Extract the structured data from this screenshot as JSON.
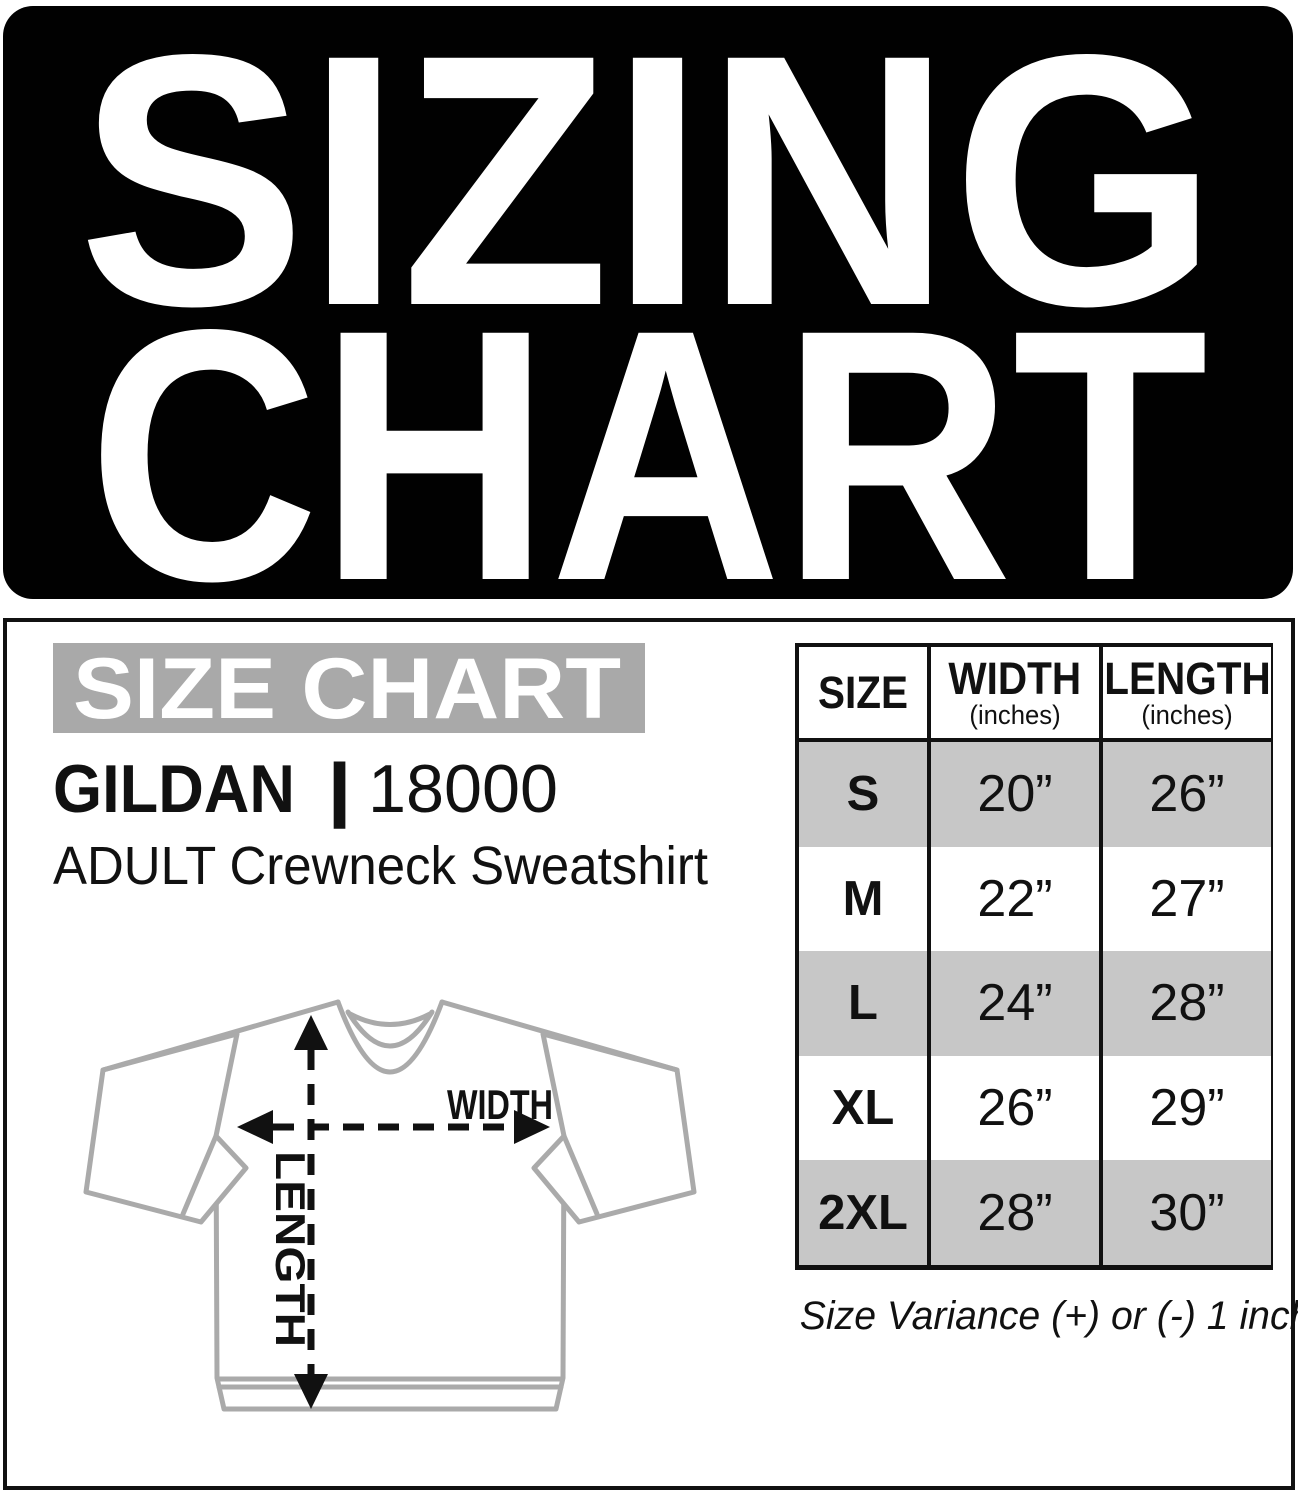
{
  "banner": {
    "line1": "SIZING",
    "line2": "CHART"
  },
  "panel": {
    "bar_title": "SIZE CHART",
    "brand": "GILDAN",
    "separator": "|",
    "model": "18000",
    "product": "ADULT Crewneck Sweatshirt",
    "diagram": {
      "width_label": "WIDTH",
      "length_label": "LENGTH"
    },
    "table": {
      "headers": [
        {
          "label": "SIZE",
          "sub": ""
        },
        {
          "label": "WIDTH",
          "sub": "(inches)"
        },
        {
          "label": "LENGTH",
          "sub": "(inches)"
        }
      ],
      "rows": [
        {
          "size": "S",
          "width": "20”",
          "length": "26”"
        },
        {
          "size": "M",
          "width": "22”",
          "length": "27”"
        },
        {
          "size": "L",
          "width": "24”",
          "length": "28”"
        },
        {
          "size": "XL",
          "width": "26”",
          "length": "29”"
        },
        {
          "size": "2XL",
          "width": "28”",
          "length": "30”"
        }
      ]
    },
    "note": "Size Variance (+) or (-) 1 inch"
  },
  "chart_data": {
    "type": "table",
    "title": "SIZING CHART — GILDAN 18000 ADULT Crewneck Sweatshirt",
    "columns": [
      "SIZE",
      "WIDTH (inches)",
      "LENGTH (inches)"
    ],
    "rows": [
      [
        "S",
        20,
        26
      ],
      [
        "M",
        22,
        27
      ],
      [
        "L",
        24,
        28
      ],
      [
        "XL",
        26,
        29
      ],
      [
        "2XL",
        28,
        30
      ]
    ],
    "note": "Size Variance (+) or (-) 1 inch"
  },
  "colors": {
    "banner_bg": "#010101",
    "bar_bg": "#a9a9a9",
    "row_stripe": "#c7c7c7",
    "text": "#111111",
    "diagram_stroke": "#aaaaaa"
  }
}
